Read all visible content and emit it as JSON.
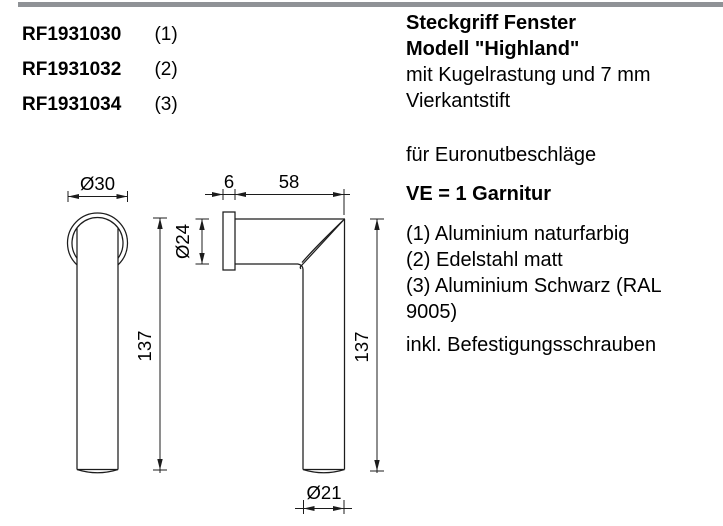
{
  "top_bar_color": "#8f9296",
  "products": [
    {
      "code": "RF1931030",
      "variant": "(1)"
    },
    {
      "code": "RF1931032",
      "variant": "(2)"
    },
    {
      "code": "RF1931034",
      "variant": "(3)"
    }
  ],
  "description": {
    "title_line1": "Steckgriff Fenster",
    "title_line2": "Modell \"Highland\"",
    "subtitle_line1": "mit Kugelrastung und 7 mm",
    "subtitle_line2": "Vierkantstift",
    "application": "für Euronutbeschläge",
    "packaging": "VE = 1 Garnitur",
    "variants": [
      "(1) Aluminium naturfarbig",
      "(2) Edelstahl matt",
      "(3) Aluminium Schwarz (RAL 9005)"
    ],
    "note": "inkl. Befestigungsschrauben"
  },
  "drawing": {
    "dims": {
      "front_diameter": "Ø30",
      "front_height": "137",
      "rosette_thickness": "6",
      "neck_length": "58",
      "rosette_diameter": "Ø24",
      "side_height": "137",
      "grip_diameter": "Ø21"
    }
  }
}
